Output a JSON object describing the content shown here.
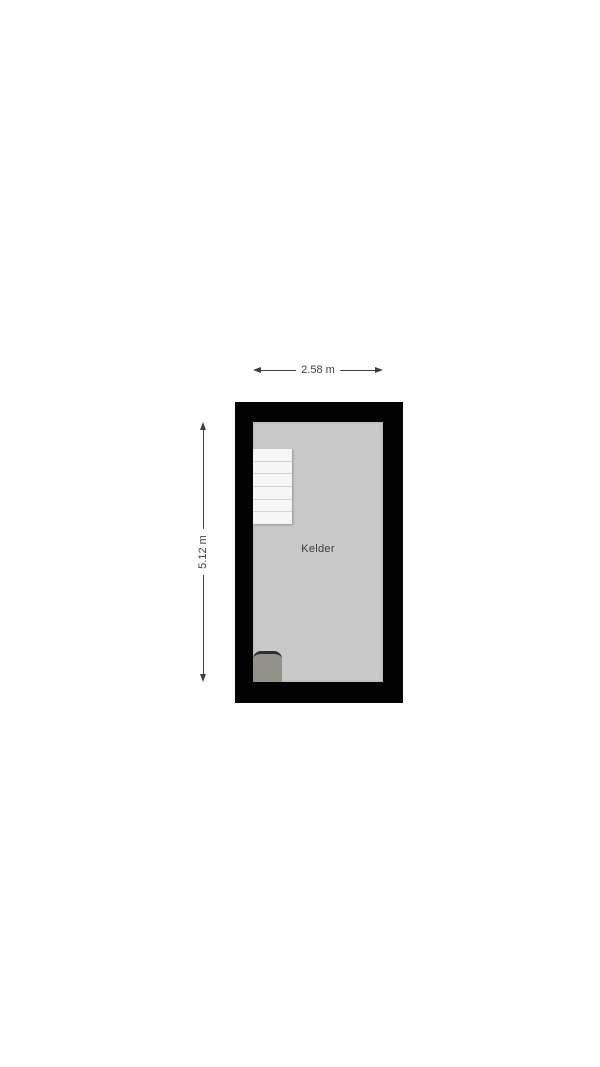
{
  "floorplan": {
    "room_label": "Kelder",
    "dimensions": {
      "width_label": "2.58 m",
      "height_label": "5.12 m"
    },
    "stairs": {
      "steps": 6
    },
    "colors": {
      "background": "#ffffff",
      "wall": "#020202",
      "floor": "#c9c9c9",
      "stair_tread": "#f6f6f6",
      "stair_line": "#d2d2d2",
      "fixture": "#92928a",
      "fixture_edge": "#2e2e2e",
      "dimension_line": "#3f3f3f",
      "text": "#3c3c3c"
    }
  }
}
